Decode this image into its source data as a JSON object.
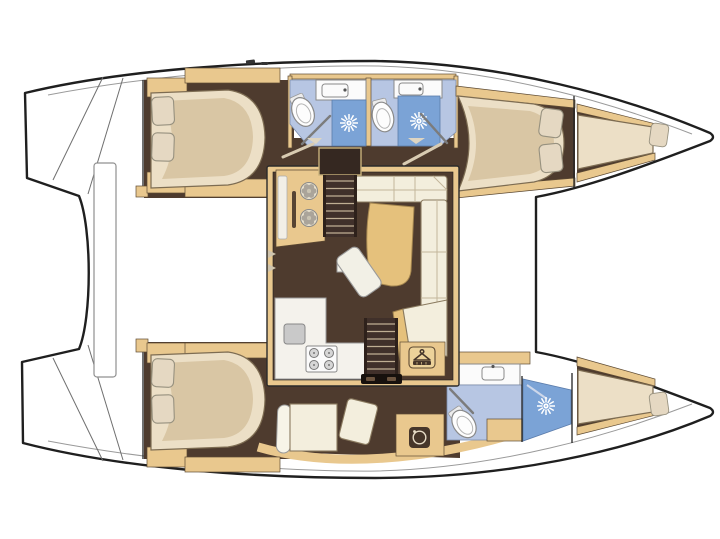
{
  "meta": {
    "type": "boat-floor-plan",
    "vessel": "sailing catamaran",
    "view": "overhead accommodation / deck plan",
    "orientation": "bow-right-stern-left"
  },
  "colors": {
    "outline": "#1f1f1f",
    "floor": "#4e3b2e",
    "stair": "#40302a",
    "wood": "#e9c88e",
    "wood_edge": "#5d4a33",
    "bed": "#ecdfc6",
    "bed_shade": "#d9c6a4",
    "pillow": "#e5d8c2",
    "bath": "#b7c6e3",
    "shower": "#7ba3d6",
    "fixture": "#fbfbfb",
    "hardware": "#8a8a8a",
    "sofa": "#f3eedd",
    "cushion": "#e5c17c",
    "tread": "#bfae93",
    "door_leaf": "#d8cbb2",
    "background": "#ffffff"
  },
  "plan": {
    "salon": {
      "features": [
        "galley-unit-with-twin-burners",
        "four-burner-stove",
        "galley-counter",
        "l-shaped-sofa",
        "chaise-cushion",
        "dining-table",
        "wardrobe-with-hanger",
        "companionway-stairs-to-port-hull",
        "companionway-stairs-to-starboard-hull"
      ]
    },
    "port_hull": {
      "position": "top",
      "rooms": [
        {
          "name": "aft-double-cabin",
          "features": [
            "island-double-berth",
            "two-pillows",
            "storage-cabinets"
          ]
        },
        {
          "name": "aft-bathroom",
          "features": [
            "toilet",
            "sink",
            "shower-stall"
          ]
        },
        {
          "name": "forward-bathroom",
          "features": [
            "toilet",
            "sink",
            "shower-stall"
          ]
        },
        {
          "name": "forward-double-cabin",
          "features": [
            "double-berth",
            "two-pillows"
          ]
        },
        {
          "name": "forepeak-berth",
          "features": [
            "single-berth",
            "pillow"
          ]
        }
      ]
    },
    "starboard_hull": {
      "position": "bottom",
      "rooms": [
        {
          "name": "aft-double-cabin",
          "features": [
            "island-double-berth",
            "two-pillows",
            "storage-cabinets"
          ]
        },
        {
          "name": "dressing-area",
          "features": [
            "settee",
            "vanity-unit",
            "washing-machine"
          ]
        },
        {
          "name": "forward-bathroom",
          "features": [
            "toilet",
            "sink",
            "shower-stall"
          ]
        },
        {
          "name": "forepeak-berth",
          "features": [
            "single-berth",
            "pillow"
          ]
        }
      ]
    },
    "exterior": {
      "features": [
        "port-transom-steps",
        "starboard-transom-steps",
        "aft-platform-beam",
        "side-deck-lines",
        "twin-bow-tips",
        "cleats"
      ]
    },
    "icons": [
      {
        "name": "shower-head-starburst",
        "meaning": "shower spray"
      },
      {
        "name": "coat-hanger",
        "meaning": "wardrobe / hanging locker"
      },
      {
        "name": "washing-machine",
        "meaning": "washer"
      },
      {
        "name": "stove-burners",
        "meaning": "4-burner cooktop"
      },
      {
        "name": "twin-burners",
        "meaning": "galley hob"
      },
      {
        "name": "toilet",
        "meaning": "marine WC"
      },
      {
        "name": "sink",
        "meaning": "wash basin"
      }
    ]
  }
}
